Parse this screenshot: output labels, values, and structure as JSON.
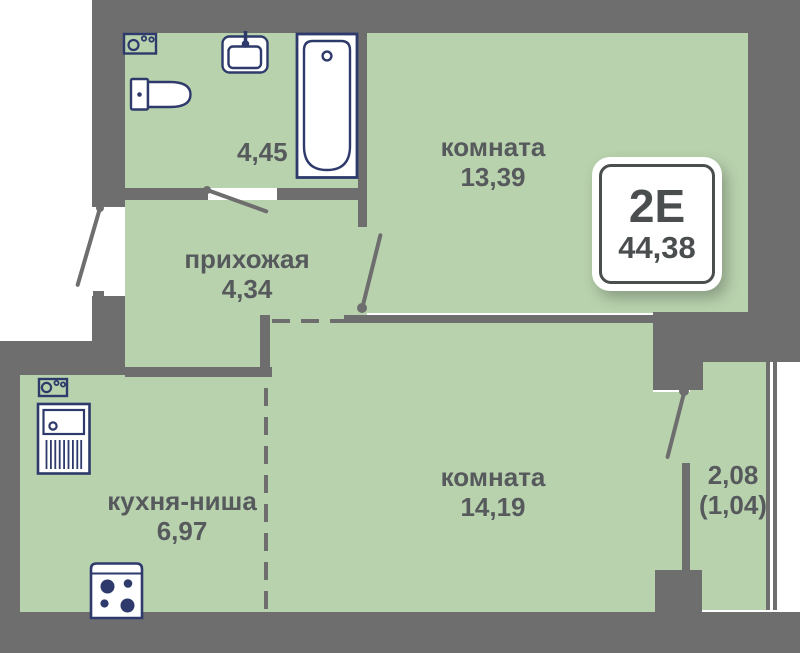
{
  "plan": {
    "title": "apartment-floor-plan",
    "badge": {
      "layout_type": "2Е",
      "total_area": "44,38"
    },
    "rooms": {
      "bathroom": {
        "area": "4,45"
      },
      "room_top": {
        "name": "комната",
        "area": "13,39"
      },
      "hallway": {
        "name": "прихожая",
        "area": "4,34"
      },
      "kitchen": {
        "name": "кухня-ниша",
        "area": "6,97"
      },
      "room_bottom": {
        "name": "комната",
        "area": "14,19"
      },
      "balcony": {
        "area": "2,08",
        "area_reduced": "(1,04)"
      }
    },
    "fixtures": [
      "washing-machine-icon",
      "sink-icon",
      "toilet-icon",
      "bathtub-icon",
      "kitchen-sink-icon",
      "stove-icon"
    ],
    "colors": {
      "background": "#ffffff",
      "room_fill": "#b9d2ae",
      "wall": "#6e6e6e",
      "fixture_outline": "#2e3a6b",
      "label_text": "#565a5c",
      "badge_text": "#4a4e4f"
    }
  }
}
